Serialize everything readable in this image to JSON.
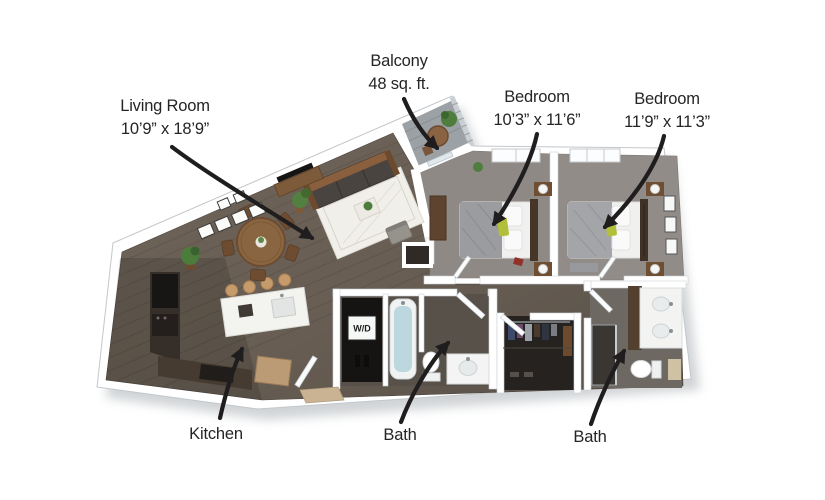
{
  "canvas": {
    "width": 825,
    "height": 500,
    "background": "#ffffff"
  },
  "floorplan": {
    "type": "3d-rendered apartment floor plan, 2 bed / 2 bath",
    "labels": {
      "living_room": {
        "name": "Living Room",
        "dimensions": "10’9” x 18’9”"
      },
      "balcony": {
        "name": "Balcony",
        "area": "48 sq. ft."
      },
      "bedroom_1": {
        "name": "Bedroom",
        "dimensions": "10’3” x 11’6”"
      },
      "bedroom_2": {
        "name": "Bedroom",
        "dimensions": "11’9” x 11’3”"
      },
      "kitchen": {
        "name": "Kitchen"
      },
      "bath_1": {
        "name": "Bath"
      },
      "bath_2": {
        "name": "Bath"
      }
    },
    "fixtures": {
      "washer_dryer": "W/D"
    },
    "colors": {
      "label_text": "#262425",
      "arrow": "#1f1d1e",
      "wall": "#ffffff",
      "wall_edge": "#c2c7cb",
      "wood_floor": "#6f6459",
      "wood_floor_dark": "#574f47",
      "carpet": "#8e8984",
      "bath_floor": "#58514a",
      "closet_floor": "#262220",
      "balcony_floor": "#9ba1a5",
      "tub_water": "#bdd7de",
      "accent_green": "#b2bf3a",
      "furniture_wood": "#8a6542",
      "counter_dark": "#352e29"
    }
  }
}
